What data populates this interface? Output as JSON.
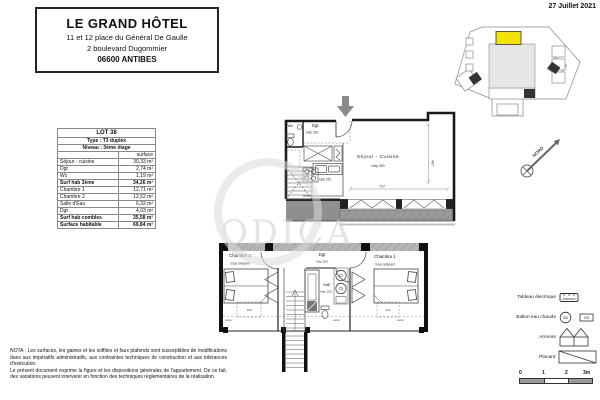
{
  "page": {
    "date": "27 Juillet 2021",
    "watermark": "ODICA"
  },
  "title_block": {
    "hotel": "LE GRAND HÔTEL",
    "address1": "11 et 12 place du Général De Gaulle",
    "address2": "2 boulevard Dugommier",
    "city": "06600 ANTIBES"
  },
  "lot_table": {
    "title": "LOT 38",
    "type": "Type : T3 duplex",
    "level": "Niveau : 3ème étage",
    "surface_header": "surface",
    "rows": [
      {
        "label": "Séjour - cuisine",
        "value": "30,33 m²"
      },
      {
        "label": "Dgt",
        "value": "2,74 m²"
      },
      {
        "label": "Wc",
        "value": "1,19 m²"
      },
      {
        "label": "Surf hab 3ème",
        "value": "34,26 m²"
      },
      {
        "label": "Chambre 1",
        "value": "12,71 m²"
      },
      {
        "label": "Chambre 2",
        "value": "12,52 m²"
      },
      {
        "label": "Salle d'Eau",
        "value": "6,32 m²"
      },
      {
        "label": "Dgt",
        "value": "4,03 m²"
      },
      {
        "label": "Surf hab combles",
        "value": "35,58 m²"
      },
      {
        "label": "Surface habitable",
        "value": "69,84 m²"
      }
    ]
  },
  "plan_upper": {
    "wc": "Wc",
    "dgt": "Dgt",
    "dgt_height": "hsfp 250",
    "kitchen_height": "hsfp 250",
    "room": "Séjour - Cuisine",
    "room_height": "hsfp 260",
    "dim_width": "707",
    "dim_height": "467"
  },
  "plan_lower": {
    "chambre2": "Chambre 2",
    "chambre2_note": "sous rampant",
    "chambre1": "Chambre 1",
    "chambre1_note": "sous rampant",
    "dgt": "Dgt",
    "dgt_height": "hsfp 250",
    "sde": "SdE",
    "sde_height": "hsfp 250",
    "velux1": "velux",
    "velux2": "velux",
    "velux3": "velux",
    "dim_velux_left": "169",
    "dim_velux_right": "124"
  },
  "north": {
    "label": "NORD"
  },
  "legend": {
    "electrical": "Tableau électrique",
    "water_heater": "Ballon eau chaude",
    "water_heater_300": "300",
    "water_heater_200": "200",
    "wardrobe": "Armoire",
    "closet": "Placard"
  },
  "scale": {
    "t0": "0",
    "t1": "1",
    "t2": "2",
    "t3": "3m"
  },
  "nota": {
    "line1": "NOTA : Les surfaces, les gaines et les soffites et faux plafonds sont susceptibles de modifications dues aux impératifs administratifs, aux contraintes techniques de construction et aux tolérances d'exécution.",
    "line2": "Le présent document exprime la figure et les dispositions générales de l'appartement. De ce fait, des variations peuvent intervenir en fonction des techniques réglementaires de la réalisation."
  },
  "colors": {
    "highlight": "#f5e400",
    "wall": "#1a1a1a",
    "band_gray": "#9a9a9a"
  }
}
